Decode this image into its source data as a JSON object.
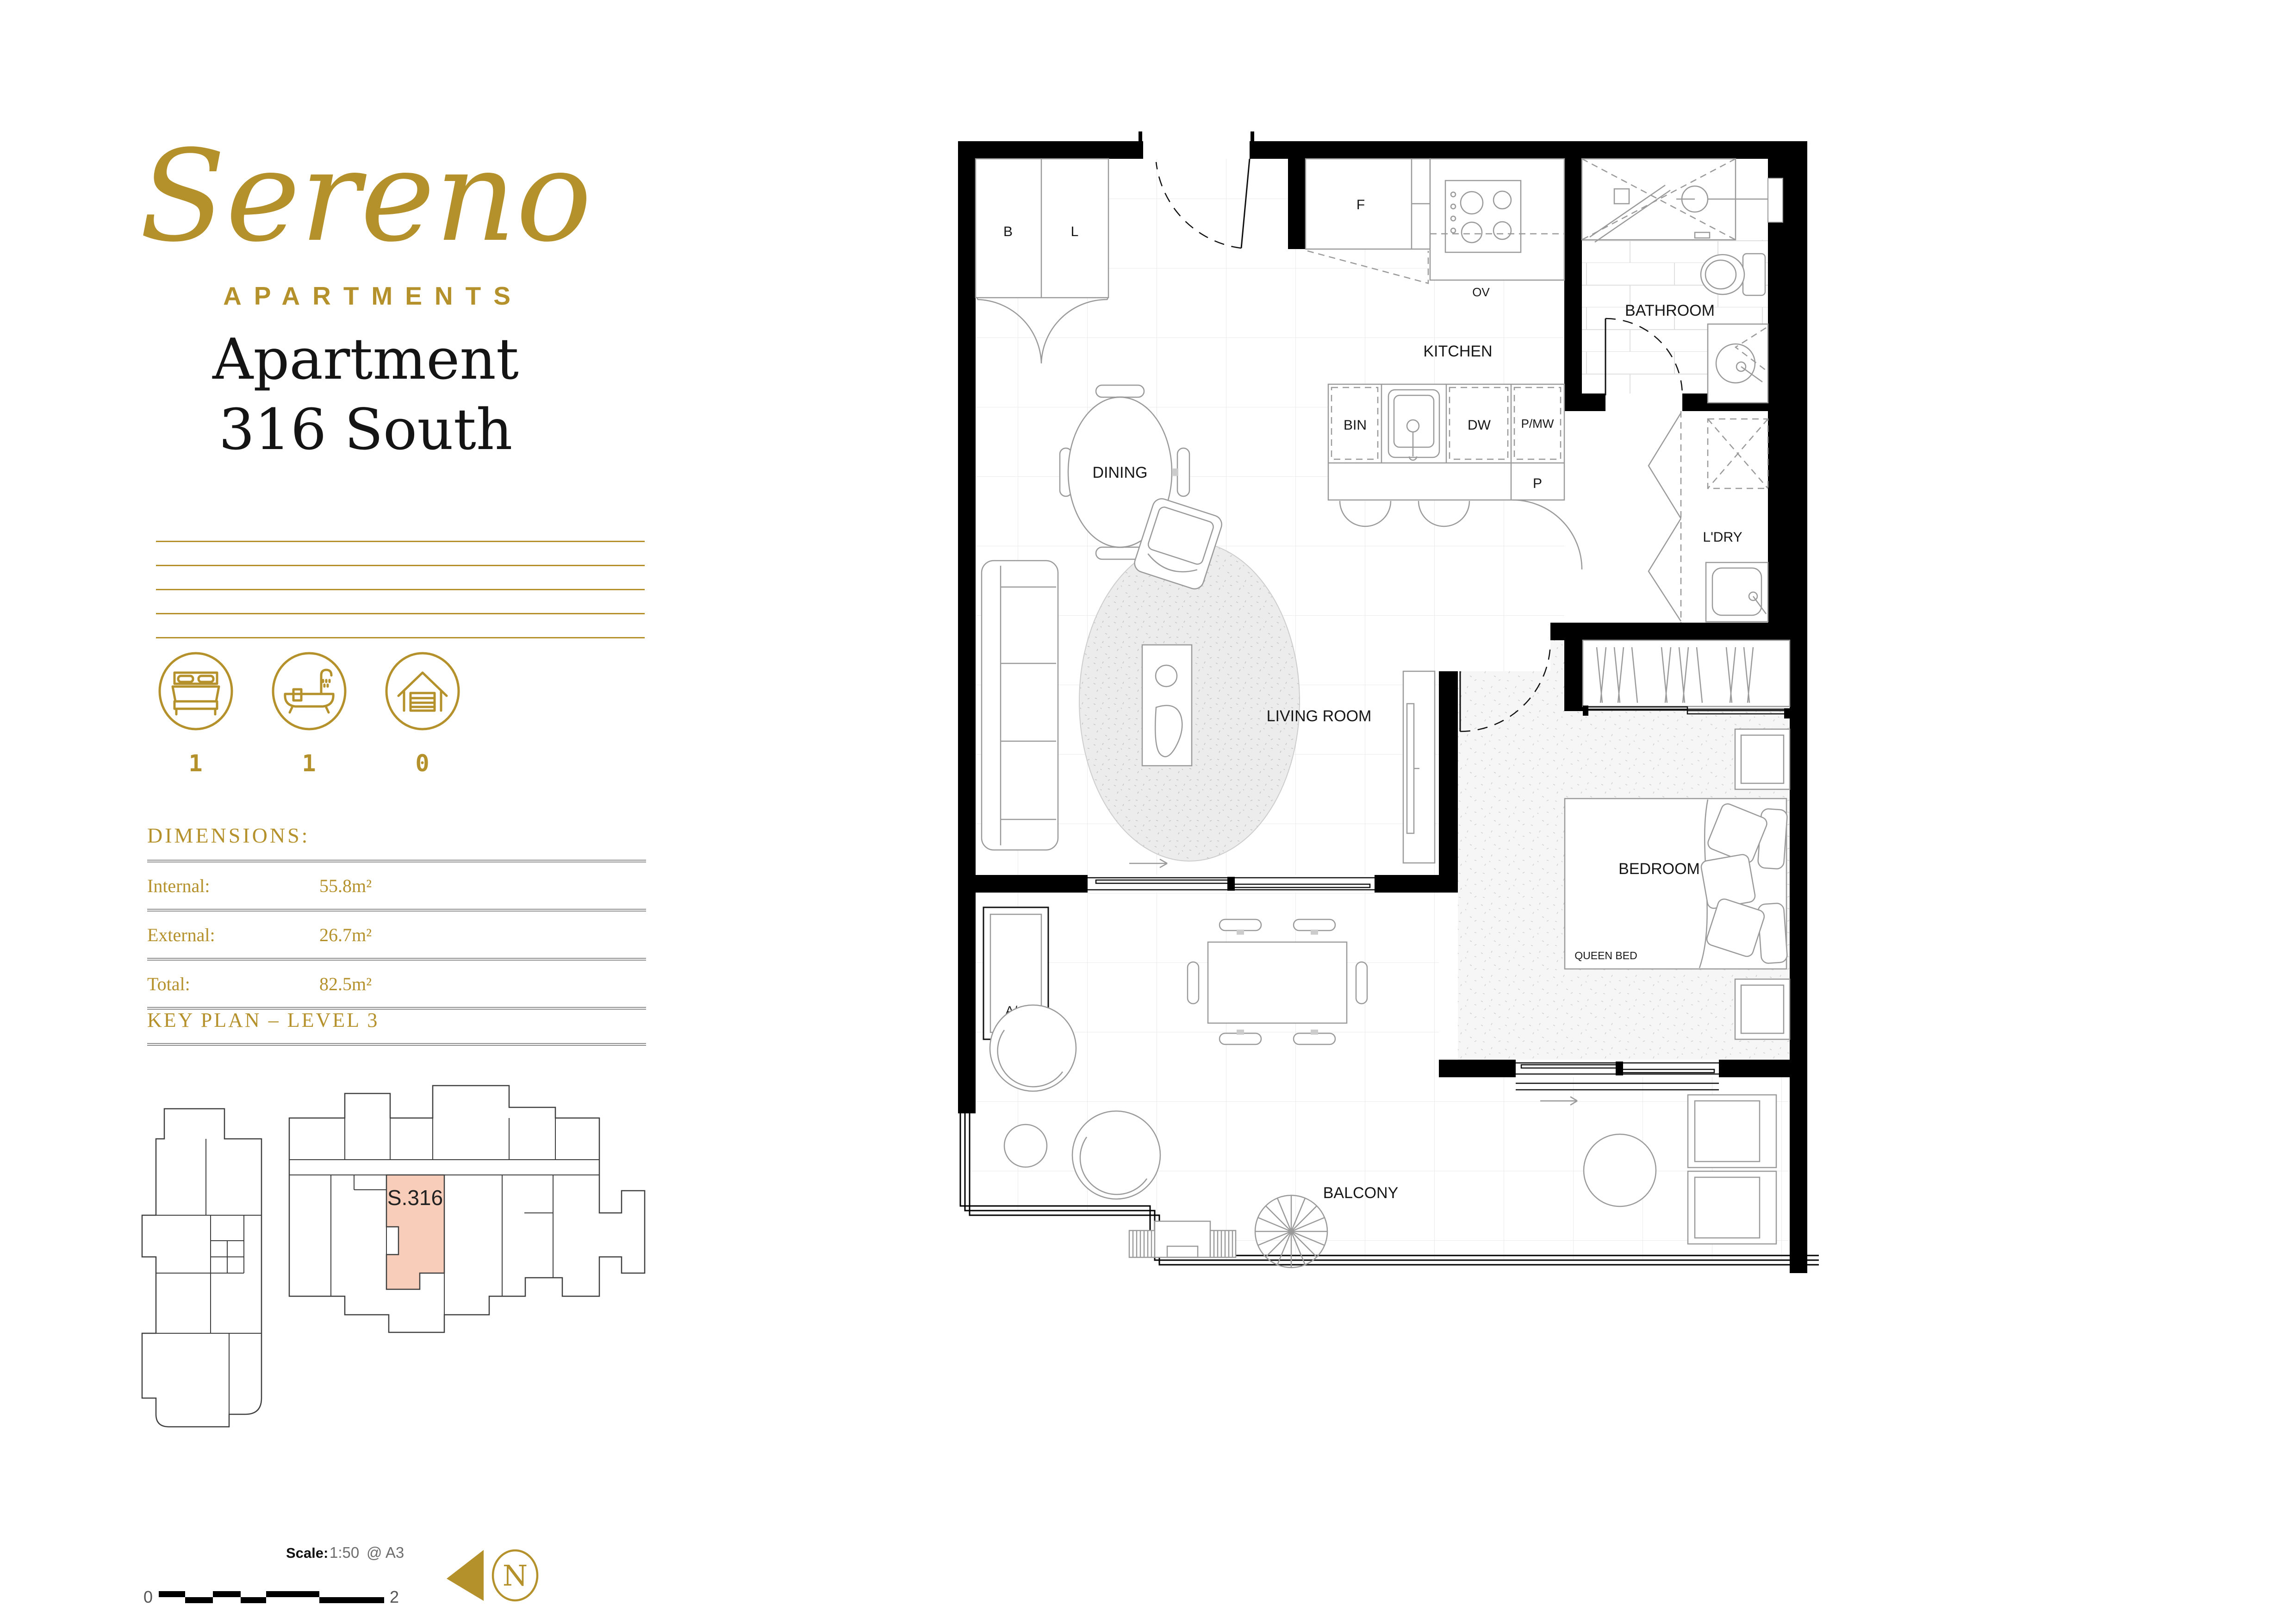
{
  "colors": {
    "accent": "#B5912C",
    "highlight": "#F8CDBA",
    "wall": "#000000"
  },
  "brand": {
    "name": "Sereno",
    "tagline": "APARTMENTS"
  },
  "title": {
    "line1": "Apartment",
    "line2": "316 South"
  },
  "features": {
    "items": [
      {
        "icon": "bed-icon",
        "count": "1"
      },
      {
        "icon": "bath-icon",
        "count": "1"
      },
      {
        "icon": "garage-icon",
        "count": "0"
      }
    ]
  },
  "dimensions": {
    "heading": "DIMENSIONS:",
    "rows": [
      {
        "label": "Internal:",
        "value": "55.8m²"
      },
      {
        "label": "External:",
        "value": "26.7m²"
      },
      {
        "label": "Total:",
        "value": "82.5m²"
      }
    ]
  },
  "key_plan": {
    "heading": "KEY PLAN – LEVEL 3",
    "unit": "S.316"
  },
  "plan": {
    "labels": {
      "broom": "B",
      "linen": "L",
      "fridge": "F",
      "oven": "OV",
      "kitchen": "KITCHEN",
      "dining": "DINING",
      "bin": "BIN",
      "dishwasher": "DW",
      "pantry_microwave": "P/MW",
      "pantry": "P",
      "bathroom": "BATHROOM",
      "laundry": "L'DRY",
      "living": "LIVING ROOM",
      "bedroom": "BEDROOM",
      "queen_bed": "QUEEN BED",
      "ac": "A/C",
      "balcony": "BALCONY"
    }
  },
  "scale": {
    "label": "Scale:",
    "ratio": "1:50",
    "sheet": "@ A3",
    "start": "0",
    "end": "2"
  },
  "north": {
    "letter": "N"
  }
}
